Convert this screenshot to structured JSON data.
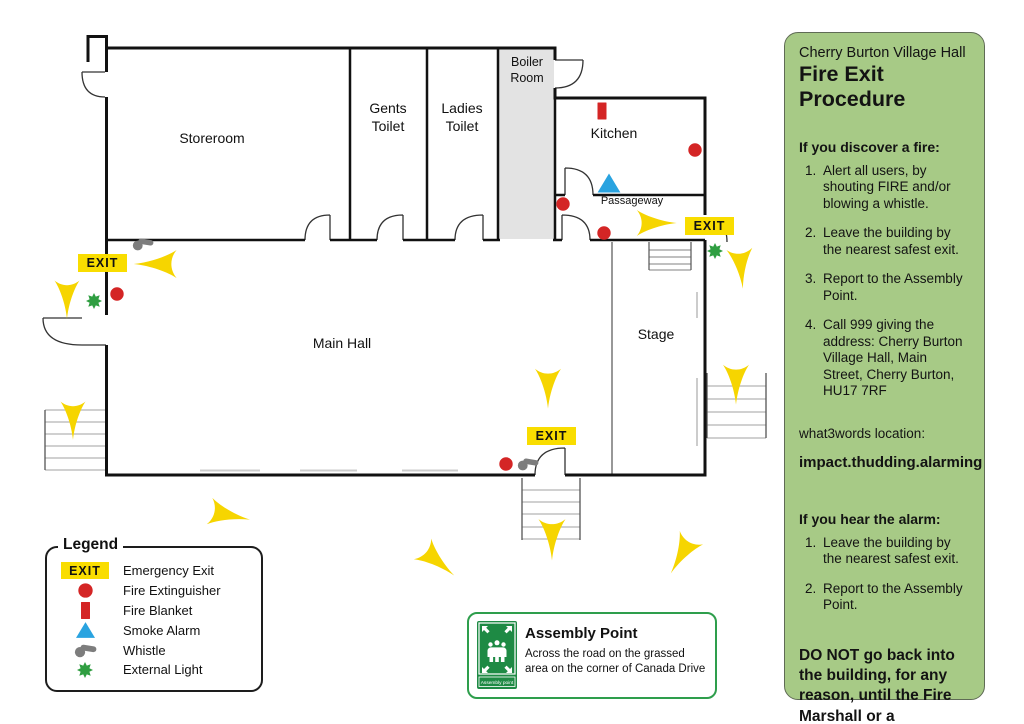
{
  "sidebar": {
    "subtitle": "Cherry Burton Village Hall",
    "title": "Fire Exit Procedure",
    "discover": {
      "heading": "If you discover a fire:",
      "items": [
        "Alert all users, by shouting FIRE and/or blowing a whistle.",
        "Leave the building by the nearest safest exit.",
        "Report to the Assembly Point.",
        "Call 999 giving the address: Cherry Burton Village Hall, Main Street, Cherry Burton, HU17 7RF"
      ]
    },
    "what3words_label": "what3words location:",
    "what3words_value": "impact.thudding.alarming",
    "alarm": {
      "heading": "If you hear the alarm:",
      "items": [
        "Leave the building by the nearest safest exit.",
        "Report to the Assembly Point."
      ]
    },
    "warning": "DO NOT go back into the building, for any reason, until the Fire Marshall or a Firefighter allows."
  },
  "plan": {
    "exit_label": "EXIT",
    "rooms": {
      "storeroom": "Storeroom",
      "gents": "Gents\nToilet",
      "ladies": "Ladies\nToilet",
      "boiler": "Boiler\nRoom",
      "kitchen": "Kitchen",
      "passageway": "Passageway",
      "main_hall": "Main Hall",
      "stage": "Stage"
    }
  },
  "legend": {
    "title": "Legend",
    "items": [
      {
        "icon": "exit-sign",
        "label": "Emergency Exit"
      },
      {
        "icon": "fire-extinguisher",
        "label": "Fire Extinguisher"
      },
      {
        "icon": "fire-blanket",
        "label": "Fire Blanket"
      },
      {
        "icon": "smoke-alarm",
        "label": "Smoke Alarm"
      },
      {
        "icon": "whistle",
        "label": "Whistle"
      },
      {
        "icon": "external-light",
        "label": "External Light"
      }
    ]
  },
  "assembly": {
    "title": "Assembly Point",
    "description": "Across the road on the grassed area on the corner of Canada Drive",
    "sign_label": "Assembly point"
  },
  "colors": {
    "sidebar_green": "#a7ca86",
    "exit_yellow": "#f9dd00",
    "arrow_yellow": "#f6d500",
    "alert_red": "#d42525",
    "alarm_blue": "#29a3e0",
    "light_green": "#2f9e41",
    "assembly_green": "#1e8a44"
  }
}
